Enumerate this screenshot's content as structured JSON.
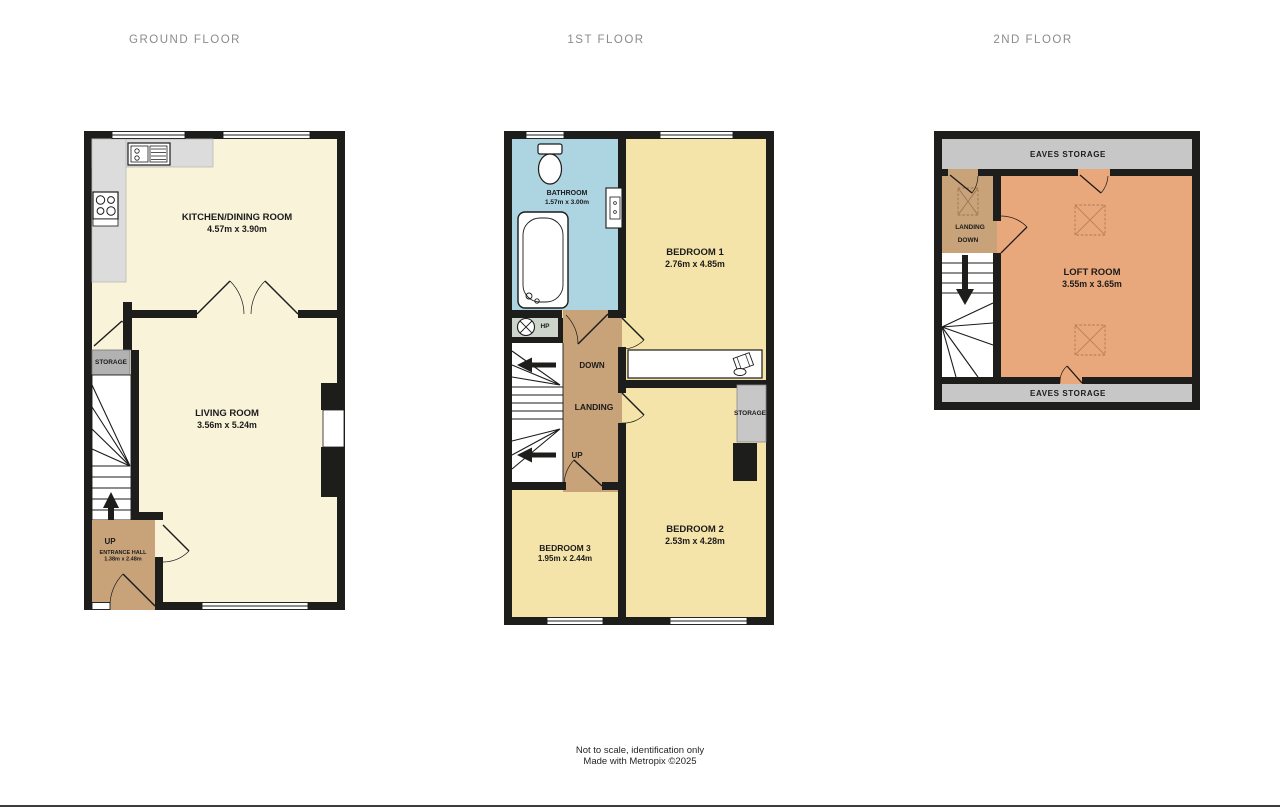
{
  "titles": {
    "ground": "GROUND FLOOR",
    "first": "1ST FLOOR",
    "second": "2ND FLOOR"
  },
  "ground": {
    "kitchen": {
      "name": "KITCHEN/DINING ROOM",
      "dims": "4.57m x 3.90m"
    },
    "living": {
      "name": "LIVING ROOM",
      "dims": "3.56m x 5.24m"
    },
    "storage": "STORAGE",
    "up": "UP",
    "hall": {
      "name": "ENTRANCE HALL",
      "dims": "1.38m x 2.48m"
    }
  },
  "first": {
    "bathroom": {
      "name": "BATHROOM",
      "dims": "1.57m x 3.00m"
    },
    "bedroom1": {
      "name": "BEDROOM 1",
      "dims": "2.76m x 4.85m"
    },
    "bedroom2": {
      "name": "BEDROOM 2",
      "dims": "2.53m x 4.28m"
    },
    "bedroom3": {
      "name": "BEDROOM 3",
      "dims": "1.95m x 2.44m"
    },
    "hp": "HP",
    "down": "DOWN",
    "landing": "LANDING",
    "up": "UP",
    "storage": "STORAGE"
  },
  "second": {
    "eaves_top": "EAVES STORAGE",
    "eaves_bottom": "EAVES STORAGE",
    "landing": "LANDING",
    "down": "DOWN",
    "loft": {
      "name": "LOFT ROOM",
      "dims": "3.55m x 3.65m"
    }
  },
  "footer": {
    "line1": "Not to scale, identification only",
    "line2": "Made with Metropix ©2025"
  },
  "colors": {
    "wall": "#1d1d1b",
    "cream": "#f8f3d9",
    "yellow": "#f5e4aa",
    "blue": "#acd4e1",
    "tan": "#c8a279",
    "orange": "#e9a77c",
    "counter": "#dcdcdc",
    "storage": "#b2b2b2",
    "eaves": "#c7c7c7",
    "hp": "#cdd5cb",
    "title": "#8b8b8b",
    "label": "#1b1b1b"
  }
}
